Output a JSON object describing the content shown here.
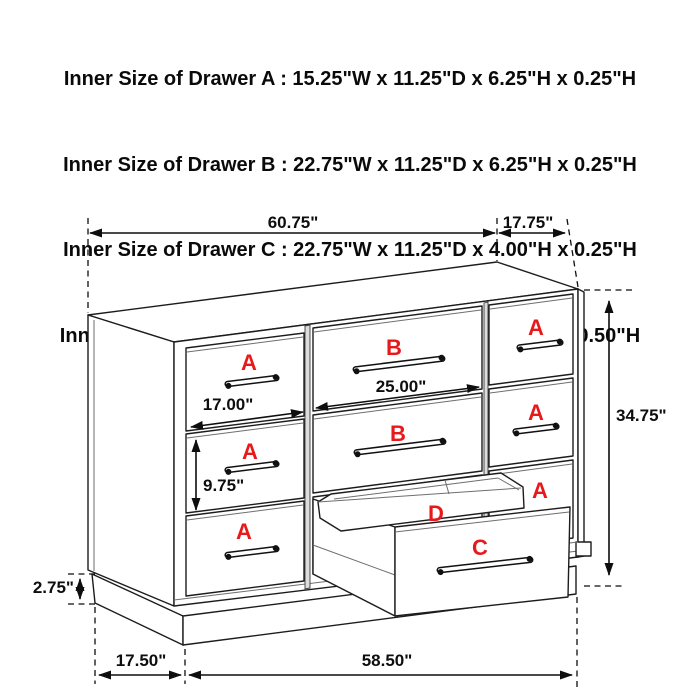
{
  "header": {
    "lines": [
      "Inner Size of Drawer A : 15.25\"W x 11.25\"D x 6.25\"H x 0.25\"H",
      "Inner Size of Drawer B : 22.75\"W x 11.25\"D x 6.25\"H x 0.25\"H",
      "Inner Size of Drawer C : 22.75\"W x 11.25\"D x 4.00\"H x 0.25\"H",
      "Inner Size of Drawer  D : 22.50\"W x 10.75\"D x 1.75\"H x 0.50\"H"
    ]
  },
  "diagram": {
    "dimensions": {
      "top_width": "60.75\"",
      "top_depth": "17.75\"",
      "overall_height": "34.75\"",
      "drawer_b_width": "25.00\"",
      "drawer_a_width": "17.00\"",
      "drawer_a_height": "9.75\"",
      "base_height": "2.75\"",
      "base_depth": "17.50\"",
      "base_width": "58.50\""
    },
    "labels": {
      "a": "A",
      "b": "B",
      "c": "C",
      "d": "D"
    },
    "colors": {
      "label_red": "#e8191b",
      "line": "#1c1c1c",
      "background": "#ffffff"
    }
  }
}
